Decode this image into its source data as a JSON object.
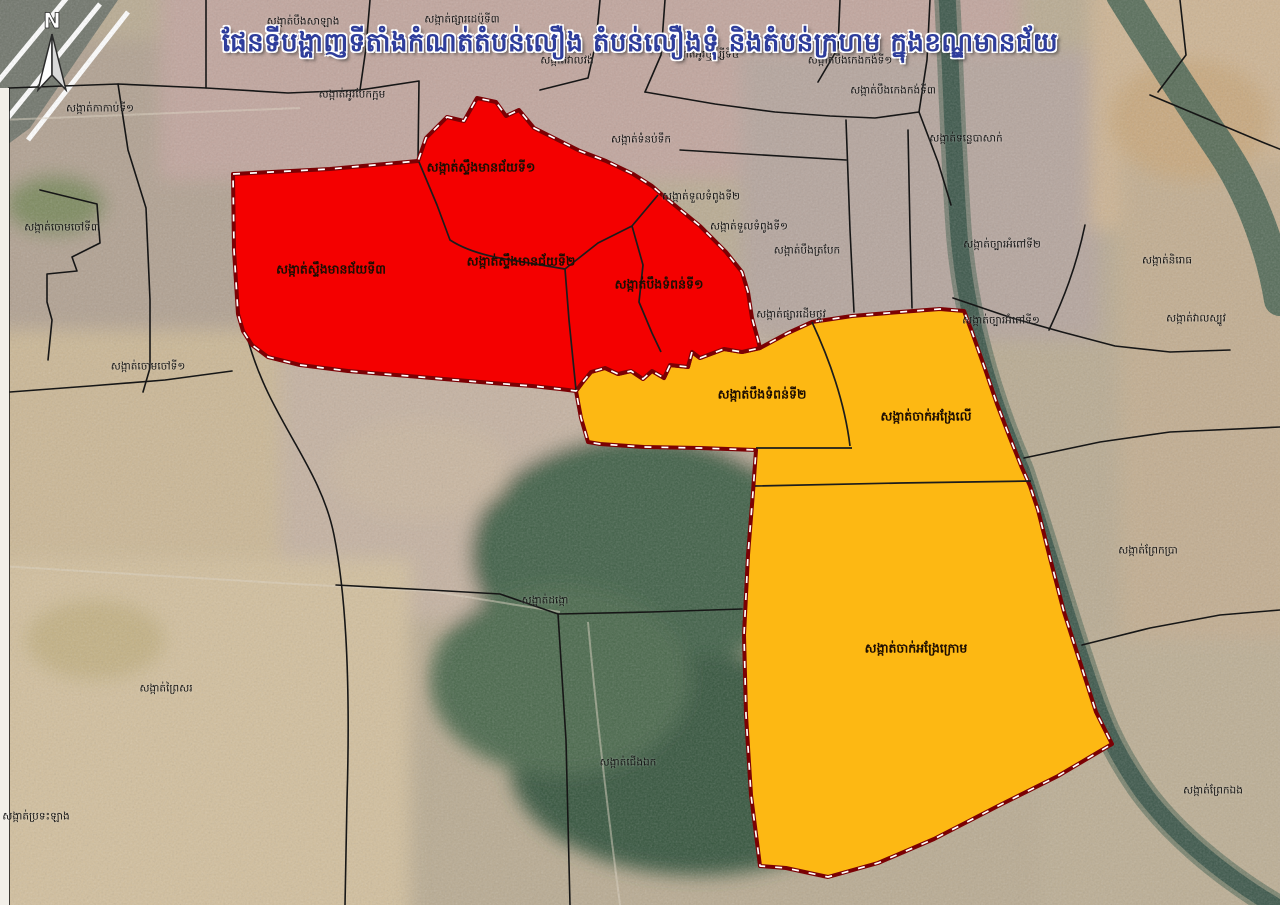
{
  "title": "ផែនទីបង្ហាញទីតាំងកំណត់តំបន់លឿង តំបន់លឿងទុំ និងតំបន់ក្រហម ក្នុងខណ្ឌមានជ័យ",
  "north_arrow": {
    "label": "N"
  },
  "colors": {
    "red_zone": "#f40000",
    "yellow_zone": "#fdb813",
    "zone_border": "#7b0104",
    "boundary_line": "#161616",
    "river": "#44604f",
    "title_text": "#2e3d9b"
  },
  "zone_labels": [
    {
      "text": "សង្កាត់ស្ទឹងមានជ័យទី១",
      "x": 481,
      "y": 169
    },
    {
      "text": "សង្កាត់ស្ទឹងមានជ័យទី៣",
      "x": 331,
      "y": 271
    },
    {
      "text": "សង្កាត់ស្ទឹងមានជ័យទី២",
      "x": 521,
      "y": 263
    },
    {
      "text": "សង្កាត់បឹងទំពន់ទី១",
      "x": 659,
      "y": 286
    },
    {
      "text": "សង្កាត់បឹងទំពន់ទី២",
      "x": 762,
      "y": 396
    },
    {
      "text": "សង្កាត់ចាក់អង្រែលើ",
      "x": 926,
      "y": 418
    },
    {
      "text": "សង្កាត់ចាក់អង្រែក្រោម",
      "x": 916,
      "y": 650
    }
  ],
  "area_labels": [
    {
      "text": "សង្កាត់កាកាប់ទី១",
      "x": 100,
      "y": 110
    },
    {
      "text": "សង្កាត់បឹងសាឡាង",
      "x": 303,
      "y": 23
    },
    {
      "text": "សង្កាត់ផ្សារដេប៉ូទី៣",
      "x": 462,
      "y": 21
    },
    {
      "text": "សង្កាត់អូរបែកក្អម",
      "x": 352,
      "y": 96
    },
    {
      "text": "សង្កាត់វាលវង់",
      "x": 567,
      "y": 62
    },
    {
      "text": "សង្កាត់អូរឬស្សីទី៤",
      "x": 704,
      "y": 56
    },
    {
      "text": "សង្កាត់បឹងកេងកង់ទី១",
      "x": 850,
      "y": 62
    },
    {
      "text": "សង្កាត់បឹងកេងកង់ទី៣",
      "x": 893,
      "y": 92
    },
    {
      "text": "សង្កាត់ទំនប់ទឹក",
      "x": 641,
      "y": 141
    },
    {
      "text": "សង្កាត់ទន្លេបាសាក់",
      "x": 966,
      "y": 140
    },
    {
      "text": "សង្កាត់ទួលទំពូងទី២",
      "x": 701,
      "y": 198
    },
    {
      "text": "សង្កាត់ទួលទំពូងទី១",
      "x": 749,
      "y": 228
    },
    {
      "text": "សង្កាត់បឹងត្របែក",
      "x": 807,
      "y": 252
    },
    {
      "text": "សង្កាត់ផ្សារដើមថ្កូវ",
      "x": 791,
      "y": 316
    },
    {
      "text": "សង្កាត់ច្បារអំពៅទី២",
      "x": 1002,
      "y": 246
    },
    {
      "text": "សង្កាត់និរោធ",
      "x": 1167,
      "y": 262
    },
    {
      "text": "សង្កាត់ច្បារអំពៅទី១",
      "x": 1001,
      "y": 322
    },
    {
      "text": "សង្កាត់វាលស្បូវ",
      "x": 1196,
      "y": 320
    },
    {
      "text": "សង្កាត់ព្រែកប្រា",
      "x": 1148,
      "y": 552
    },
    {
      "text": "សង្កាត់ព្រែកឯង",
      "x": 1213,
      "y": 792
    },
    {
      "text": "សង្កាត់ចោមចៅទី៣",
      "x": 62,
      "y": 229
    },
    {
      "text": "សង្កាត់ចោមចៅទី១",
      "x": 148,
      "y": 368
    },
    {
      "text": "សង្កាត់ដង្កោ",
      "x": 545,
      "y": 602
    },
    {
      "text": "សង្កាត់ជើងឯក",
      "x": 628,
      "y": 764
    },
    {
      "text": "សង្កាត់ព្រៃសរ",
      "x": 166,
      "y": 690
    },
    {
      "text": "សង្កាត់ប្រទះឡាង",
      "x": 36,
      "y": 818
    }
  ]
}
